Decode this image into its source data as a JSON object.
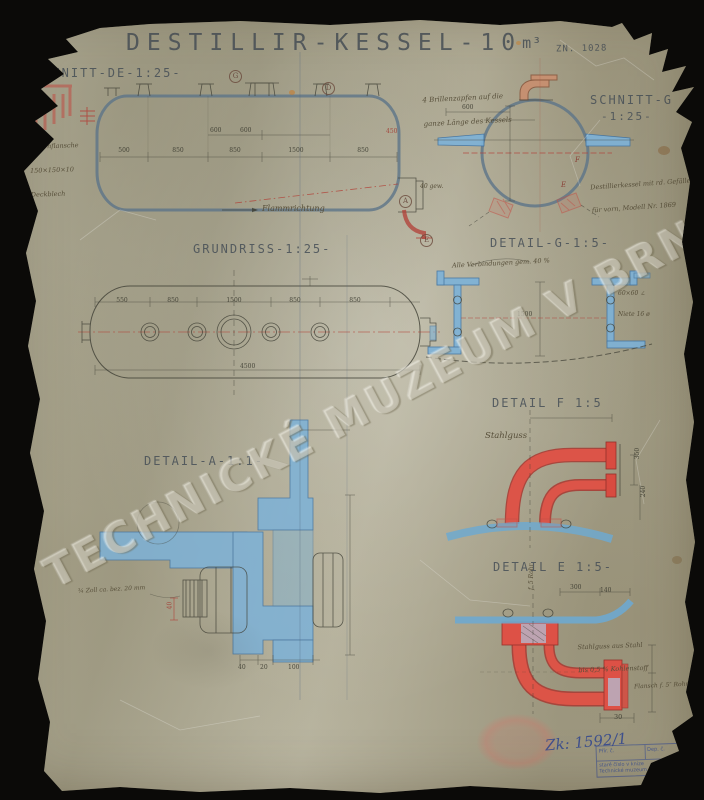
{
  "document": {
    "title": "DESTILLIR-KESSEL-10",
    "title_unit": "m³",
    "drawing_number": "ZN. 1028",
    "watermark": "TECHNICKÉ MUZEUM V BRNĚ",
    "registry_number": "Zk: 1592/1",
    "accession_stamp": {
      "cell_left": "Přír. č.",
      "cell_right": "Dep. č.",
      "org_line1": "staré číslo v knize",
      "org_line2": "Technické muzeum v Brně"
    }
  },
  "views": {
    "schnitt_de": {
      "label": "SCHNITT-DE-1:25-",
      "note_left_lines": [
        "2 Kernflansche",
        "150×150×10",
        "Deckblech"
      ],
      "dims": [
        "500",
        "850",
        "850",
        "1500",
        "850"
      ],
      "dims_inner": [
        "600",
        "600"
      ],
      "dim_red": "450",
      "flame_label": "Flammrichtung",
      "markers": [
        "G",
        "D",
        "A",
        "E"
      ]
    },
    "schnitt_g": {
      "label": "SCHNITT-G",
      "scale": "-1:25-",
      "note_top_lines": [
        "4 Brillenzapfen auf die",
        "ganze Länge des Kessels"
      ],
      "note_right_lines": [
        "Destillierkessel mit rd. Gefälle",
        "für vorn, Modell Nr. 1869"
      ],
      "dim_top": "600",
      "note_small": "40 gew.",
      "markers": [
        "F",
        "E"
      ]
    },
    "grundriss": {
      "label": "GRUNDRISS-1:25-",
      "dims": [
        "550",
        "850",
        "1500",
        "850",
        "850"
      ],
      "dim_total": "4500"
    },
    "detail_g": {
      "label": "DETAIL-G-1:5-",
      "note_top": "Alle Verbindungen gem. 40 %",
      "note_right_lines": [
        "60×60 ∠",
        "Niete 16 ø"
      ],
      "dim_mid": "1500"
    },
    "detail_f": {
      "label": "DETAIL F 1:5",
      "material": "Stahlguss",
      "dims_right": [
        "350",
        "240"
      ]
    },
    "detail_a": {
      "label": "DETAIL-A-1:1-",
      "note": "¾ Zoll ca. bez. 20 mm",
      "dim_red": "40",
      "dims_bottom": [
        "40",
        "20",
        "100"
      ]
    },
    "detail_e": {
      "label": "DETAIL E 1:5-",
      "note_material_lines": [
        "Stahlguss aus Stahl",
        "bis 0,5 % Kohlenstoff"
      ],
      "note_flange": "Flansch f. 5″ Rohr",
      "note_vertical": "f. 5 Rohr",
      "dims_top": [
        "300",
        "140"
      ],
      "dim_bottom": "30"
    }
  }
}
